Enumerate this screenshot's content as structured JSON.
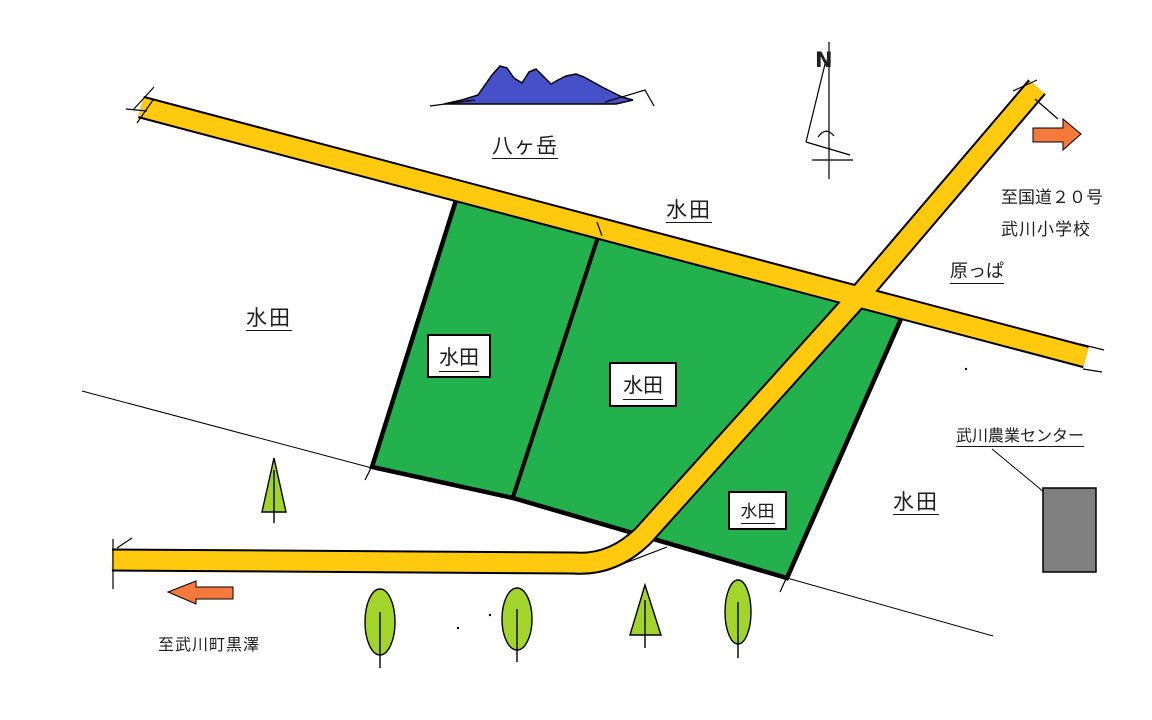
{
  "title": "hand-drawn area map",
  "colors": {
    "road_yellow": "#FFC90E",
    "field_green": "#22B14C",
    "tree_green": "#A3D42B",
    "mountain_blue": "#4650C8",
    "arrow_orange": "#F4793B",
    "building_gray": "#808080",
    "outline_black": "#000000"
  },
  "labels": {
    "mountain": "八ヶ岳",
    "north_mark": "N",
    "paddy_field": "水田",
    "grassland": "原っぱ",
    "to_route_20": "至国道２０号",
    "elementary_school": "武川小学校",
    "agriculture_center": "武川農業センター",
    "to_kurosawa": "至武川町黒澤"
  }
}
